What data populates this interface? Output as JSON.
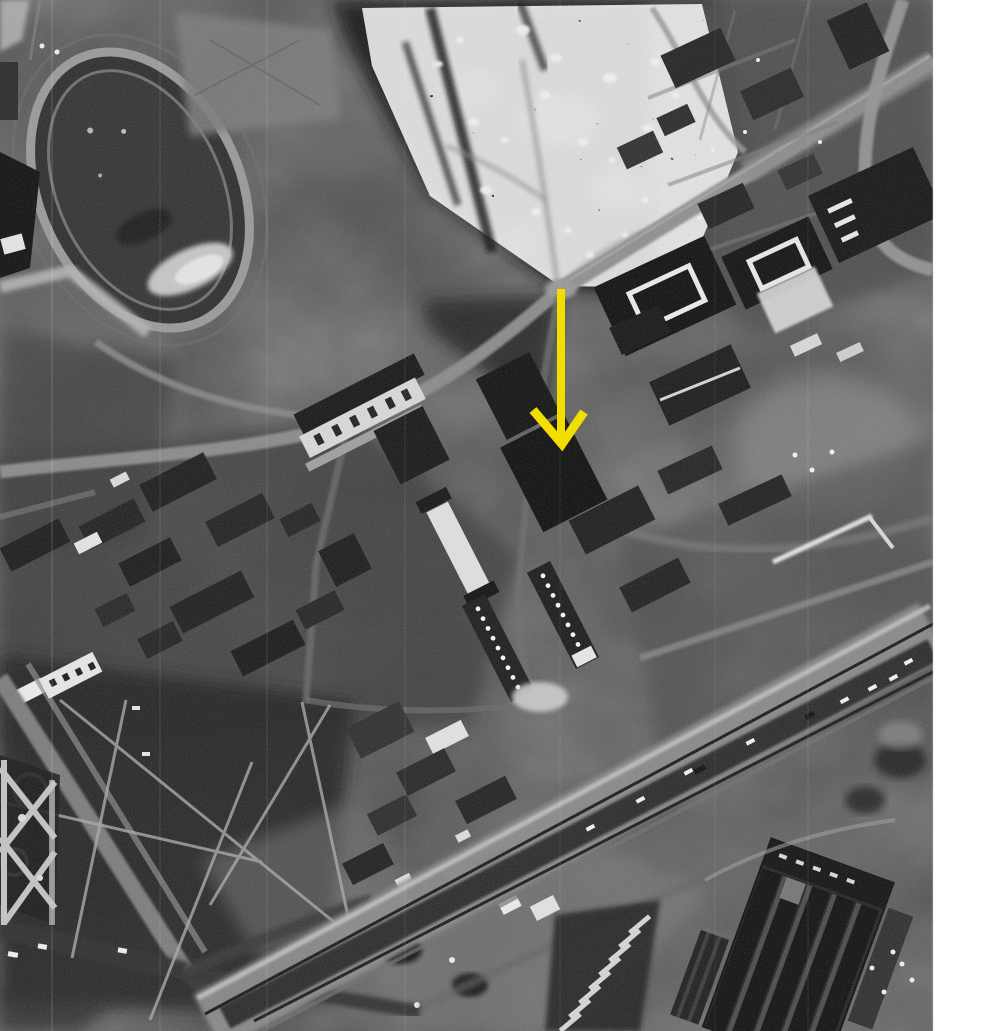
{
  "photo": {
    "style": "black-and-white aerial photograph",
    "width_px": 933,
    "height_px": 1031,
    "margin": {
      "side": "right",
      "color": "#FFFFFF",
      "width_px": 67
    }
  },
  "annotation": {
    "type": "arrow",
    "direction": "down",
    "color": "#F2DF00",
    "stroke_width": 9,
    "shaft": {
      "x": 561,
      "y_top": 289,
      "y_bottom": 441
    },
    "head": {
      "left_x": 533,
      "left_y": 410,
      "tip_x": 562,
      "tip_y": 444,
      "right_x": 584,
      "right_y": 412
    }
  },
  "palette": {
    "base_gray": "#4A4A4A",
    "dark_building": "#121212",
    "light_road": "#8B8B8B",
    "bright_roof": "#E0E0E0",
    "speck_white": "#F2F2F2"
  },
  "features": [
    {
      "name": "stadium-oval",
      "label": "stadium with oval running track"
    },
    {
      "name": "sports-field",
      "label": "light sports field"
    },
    {
      "name": "rubble-field",
      "label": "speckled rubble and tree area"
    },
    {
      "name": "main-road",
      "label": "diagonal main road to junction"
    },
    {
      "name": "barracks-complex",
      "label": "large dark blocks with white courtyards"
    },
    {
      "name": "city-blocks",
      "label": "dense residential blocks"
    },
    {
      "name": "park-paths",
      "label": "park with radiating paths"
    },
    {
      "name": "formal-garden",
      "label": "formal garden parterre"
    },
    {
      "name": "railway-corridor",
      "label": "diagonal railway and road corridor"
    },
    {
      "name": "factory-complex",
      "label": "industrial building with parallel bays"
    },
    {
      "name": "film-scratches",
      "label": "vertical film scratch lines"
    }
  ]
}
